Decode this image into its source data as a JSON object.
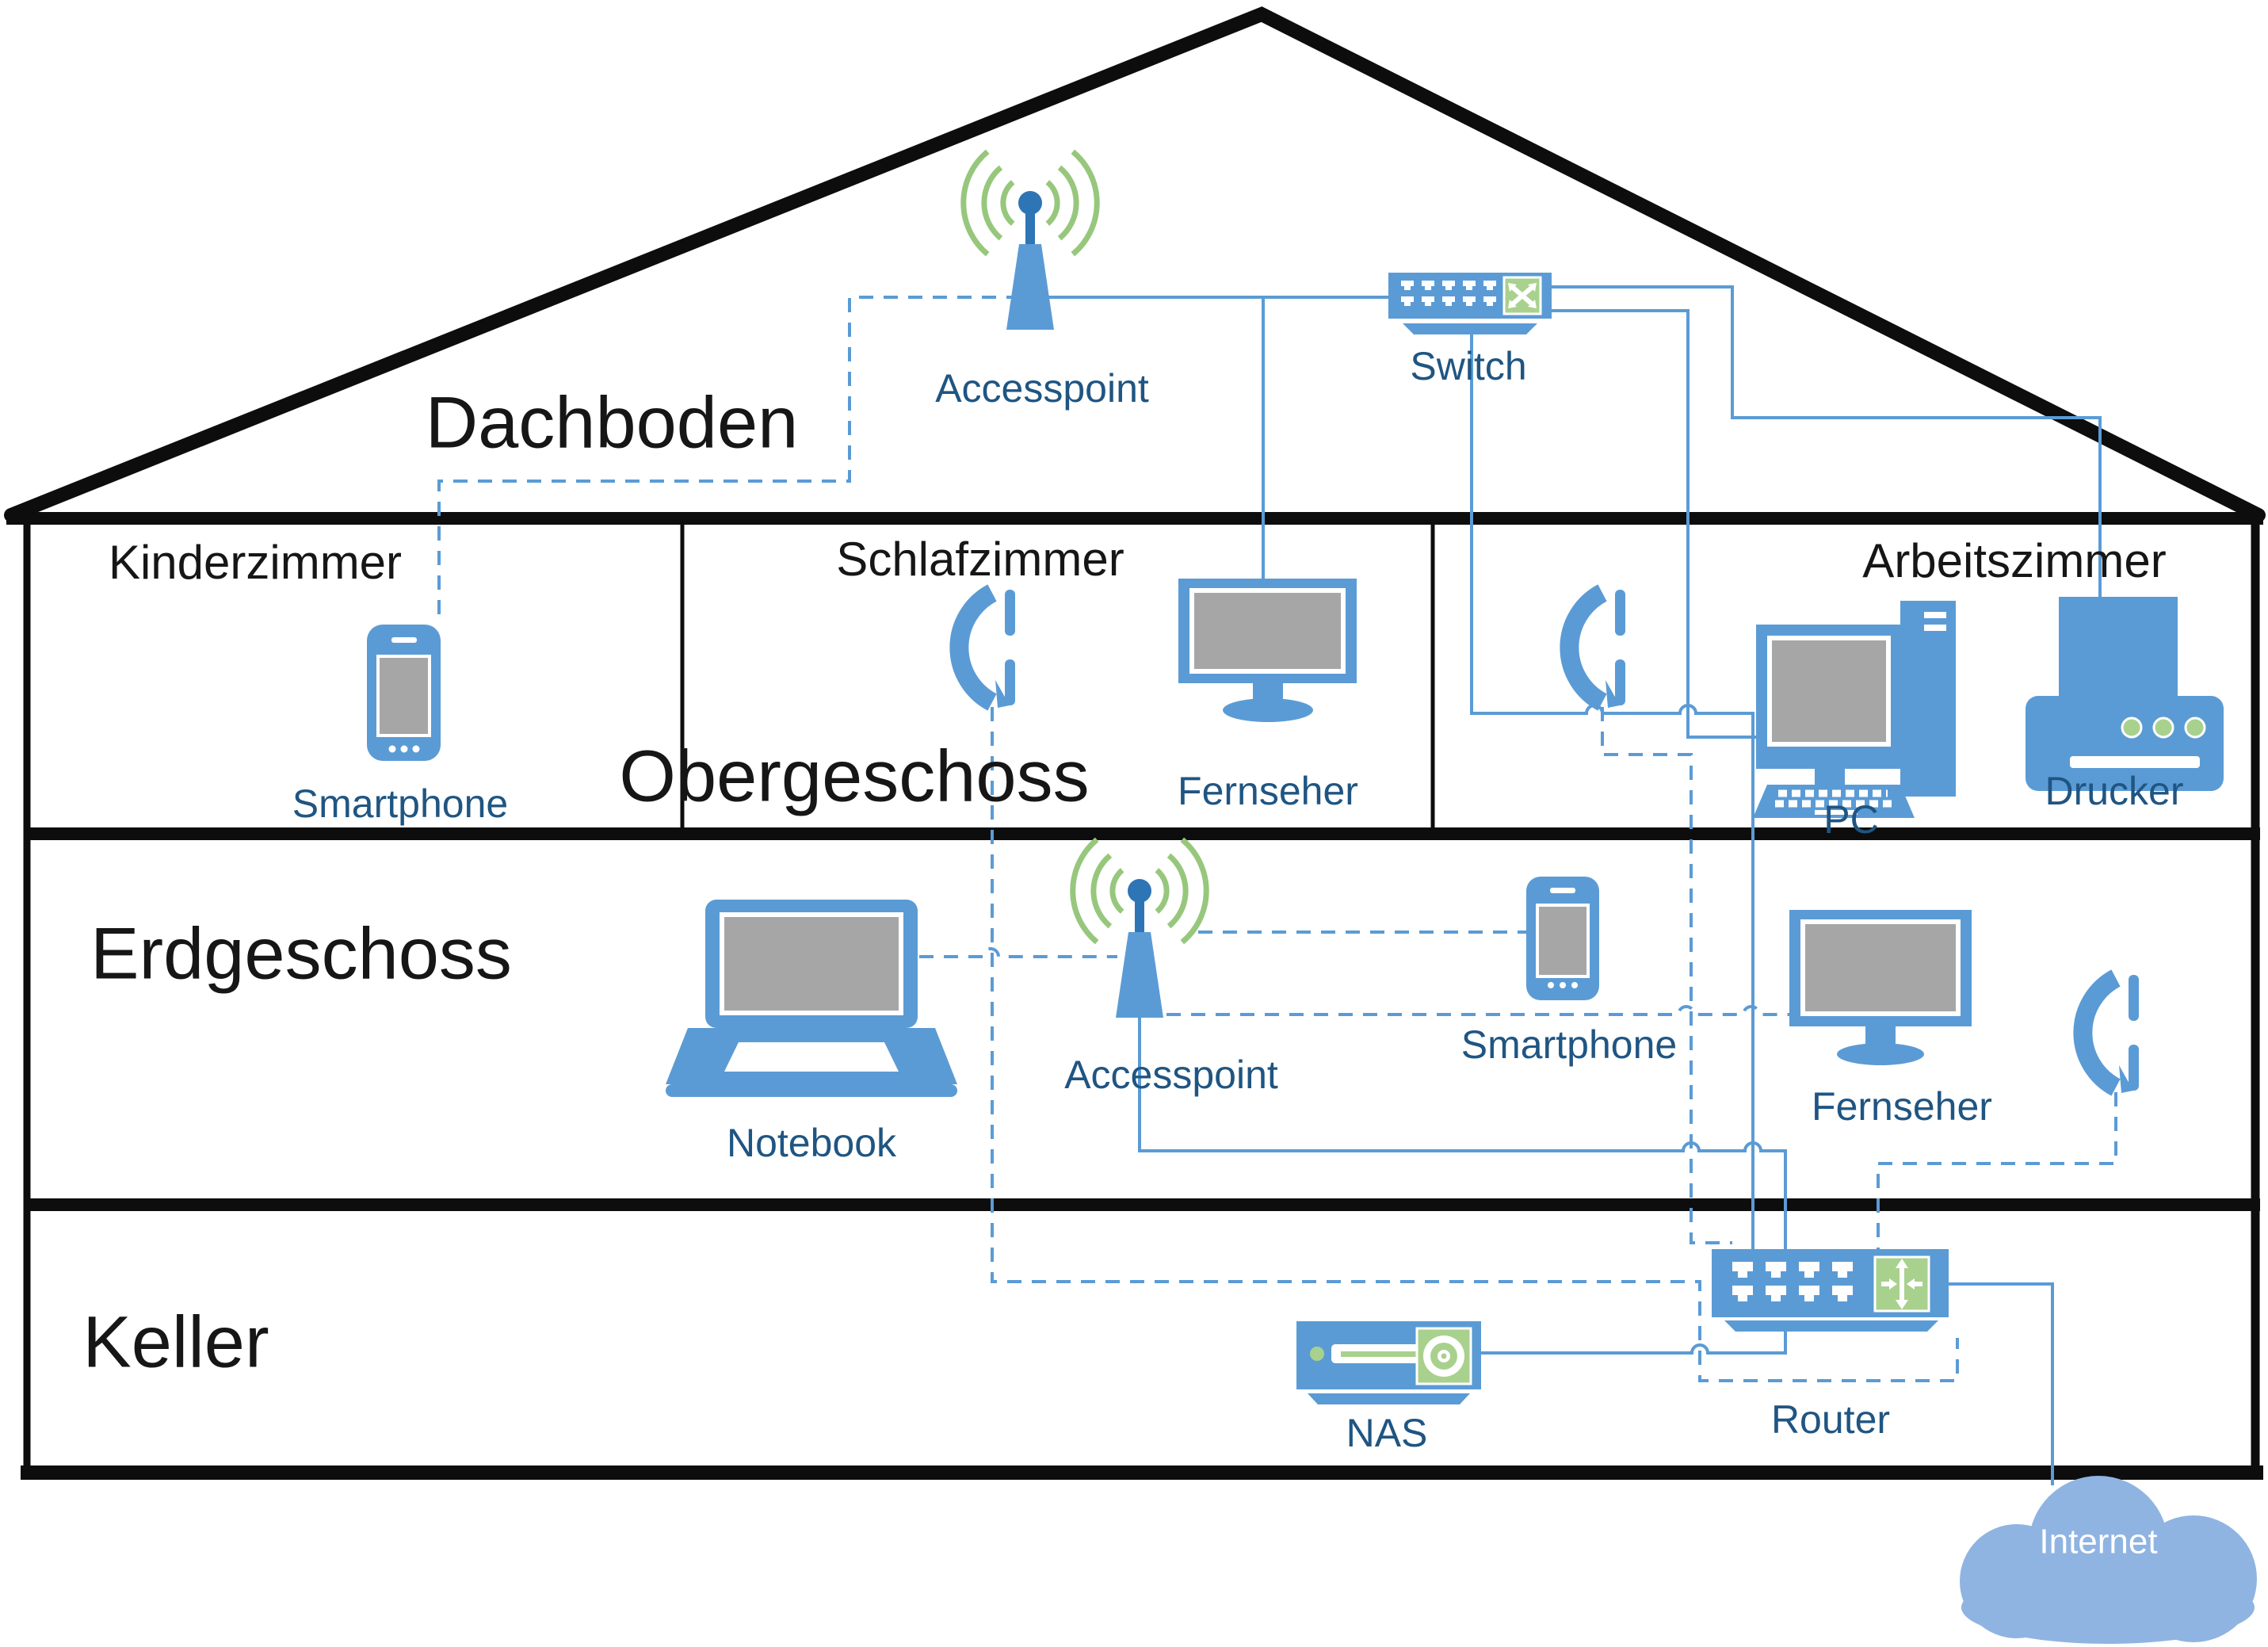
{
  "floor_labels": {
    "dachboden": "Dachboden",
    "obergeschoss": "Obergeschoss",
    "erdgeschoss": "Erdgeschoss",
    "keller": "Keller"
  },
  "room_labels": {
    "kinderzimmer": "Kinderzimmer",
    "schlafzimmer": "Schlafzimmer",
    "arbeitszimmer": "Arbeitszimmer"
  },
  "devices": {
    "accesspoint_dachboden": {
      "label": "Accesspoint",
      "type": "accesspoint",
      "location": "Dachboden"
    },
    "switch": {
      "label": "Switch",
      "type": "switch",
      "location": "Dachboden"
    },
    "smartphone_kinderzimmer": {
      "label": "Smartphone",
      "type": "smartphone",
      "location": "Kinderzimmer"
    },
    "fernseher_schlafzimmer": {
      "label": "Fernseher",
      "type": "tv",
      "location": "Schlafzimmer"
    },
    "telefon_schlafzimmer": {
      "label": "",
      "type": "phone-handset",
      "location": "Schlafzimmer"
    },
    "telefon_arbeitszimmer": {
      "label": "",
      "type": "phone-handset",
      "location": "Arbeitszimmer"
    },
    "pc_arbeitszimmer": {
      "label": "PC",
      "type": "desktop-pc",
      "location": "Arbeitszimmer"
    },
    "drucker_arbeitszimmer": {
      "label": "Drucker",
      "type": "printer",
      "location": "Arbeitszimmer"
    },
    "notebook_erdgeschoss": {
      "label": "Notebook",
      "type": "laptop",
      "location": "Erdgeschoss"
    },
    "accesspoint_erdgeschoss": {
      "label": "Accesspoint",
      "type": "accesspoint",
      "location": "Erdgeschoss"
    },
    "smartphone_erdgeschoss": {
      "label": "Smartphone",
      "type": "smartphone",
      "location": "Erdgeschoss"
    },
    "fernseher_erdgeschoss": {
      "label": "Fernseher",
      "type": "tv",
      "location": "Erdgeschoss"
    },
    "telefon_erdgeschoss": {
      "label": "",
      "type": "phone-handset",
      "location": "Erdgeschoss"
    },
    "nas": {
      "label": "NAS",
      "type": "nas",
      "location": "Keller"
    },
    "router": {
      "label": "Router",
      "type": "router",
      "location": "Keller"
    },
    "internet": {
      "label": "Internet",
      "type": "cloud",
      "location": "outside"
    }
  },
  "connections": [
    {
      "from": "accesspoint_dachboden",
      "to": "switch",
      "type": "wired"
    },
    {
      "from": "fernseher_schlafzimmer",
      "to": "switch",
      "type": "wired"
    },
    {
      "from": "switch",
      "to": "drucker_arbeitszimmer",
      "type": "wired"
    },
    {
      "from": "switch",
      "to": "pc_arbeitszimmer",
      "type": "wired"
    },
    {
      "from": "switch",
      "to": "router",
      "type": "wired"
    },
    {
      "from": "accesspoint_erdgeschoss",
      "to": "router",
      "type": "wired"
    },
    {
      "from": "nas",
      "to": "router",
      "type": "wired"
    },
    {
      "from": "router",
      "to": "internet",
      "type": "wired"
    },
    {
      "from": "accesspoint_dachboden",
      "to": "smartphone_kinderzimmer",
      "type": "wireless"
    },
    {
      "from": "telefon_schlafzimmer",
      "to": "router",
      "type": "wireless"
    },
    {
      "from": "telefon_arbeitszimmer",
      "to": "router",
      "type": "wireless"
    },
    {
      "from": "notebook_erdgeschoss",
      "to": "accesspoint_erdgeschoss",
      "type": "wireless"
    },
    {
      "from": "accesspoint_erdgeschoss",
      "to": "smartphone_erdgeschoss",
      "type": "wireless"
    },
    {
      "from": "accesspoint_erdgeschoss",
      "to": "fernseher_erdgeschoss",
      "type": "wireless"
    },
    {
      "from": "telefon_erdgeschoss",
      "to": "router",
      "type": "wireless"
    }
  ],
  "colors": {
    "device_blue": "#5b9bd5",
    "antenna_dark_blue": "#2e75b6",
    "accent_green": "#a9d18e",
    "wifi_arc_green": "#97c77c",
    "screen_gray": "#a6a6a6",
    "device_label_blue": "#1f5582",
    "cloud_blue": "#8fb4e2",
    "structure_black": "#0d0d0d"
  }
}
